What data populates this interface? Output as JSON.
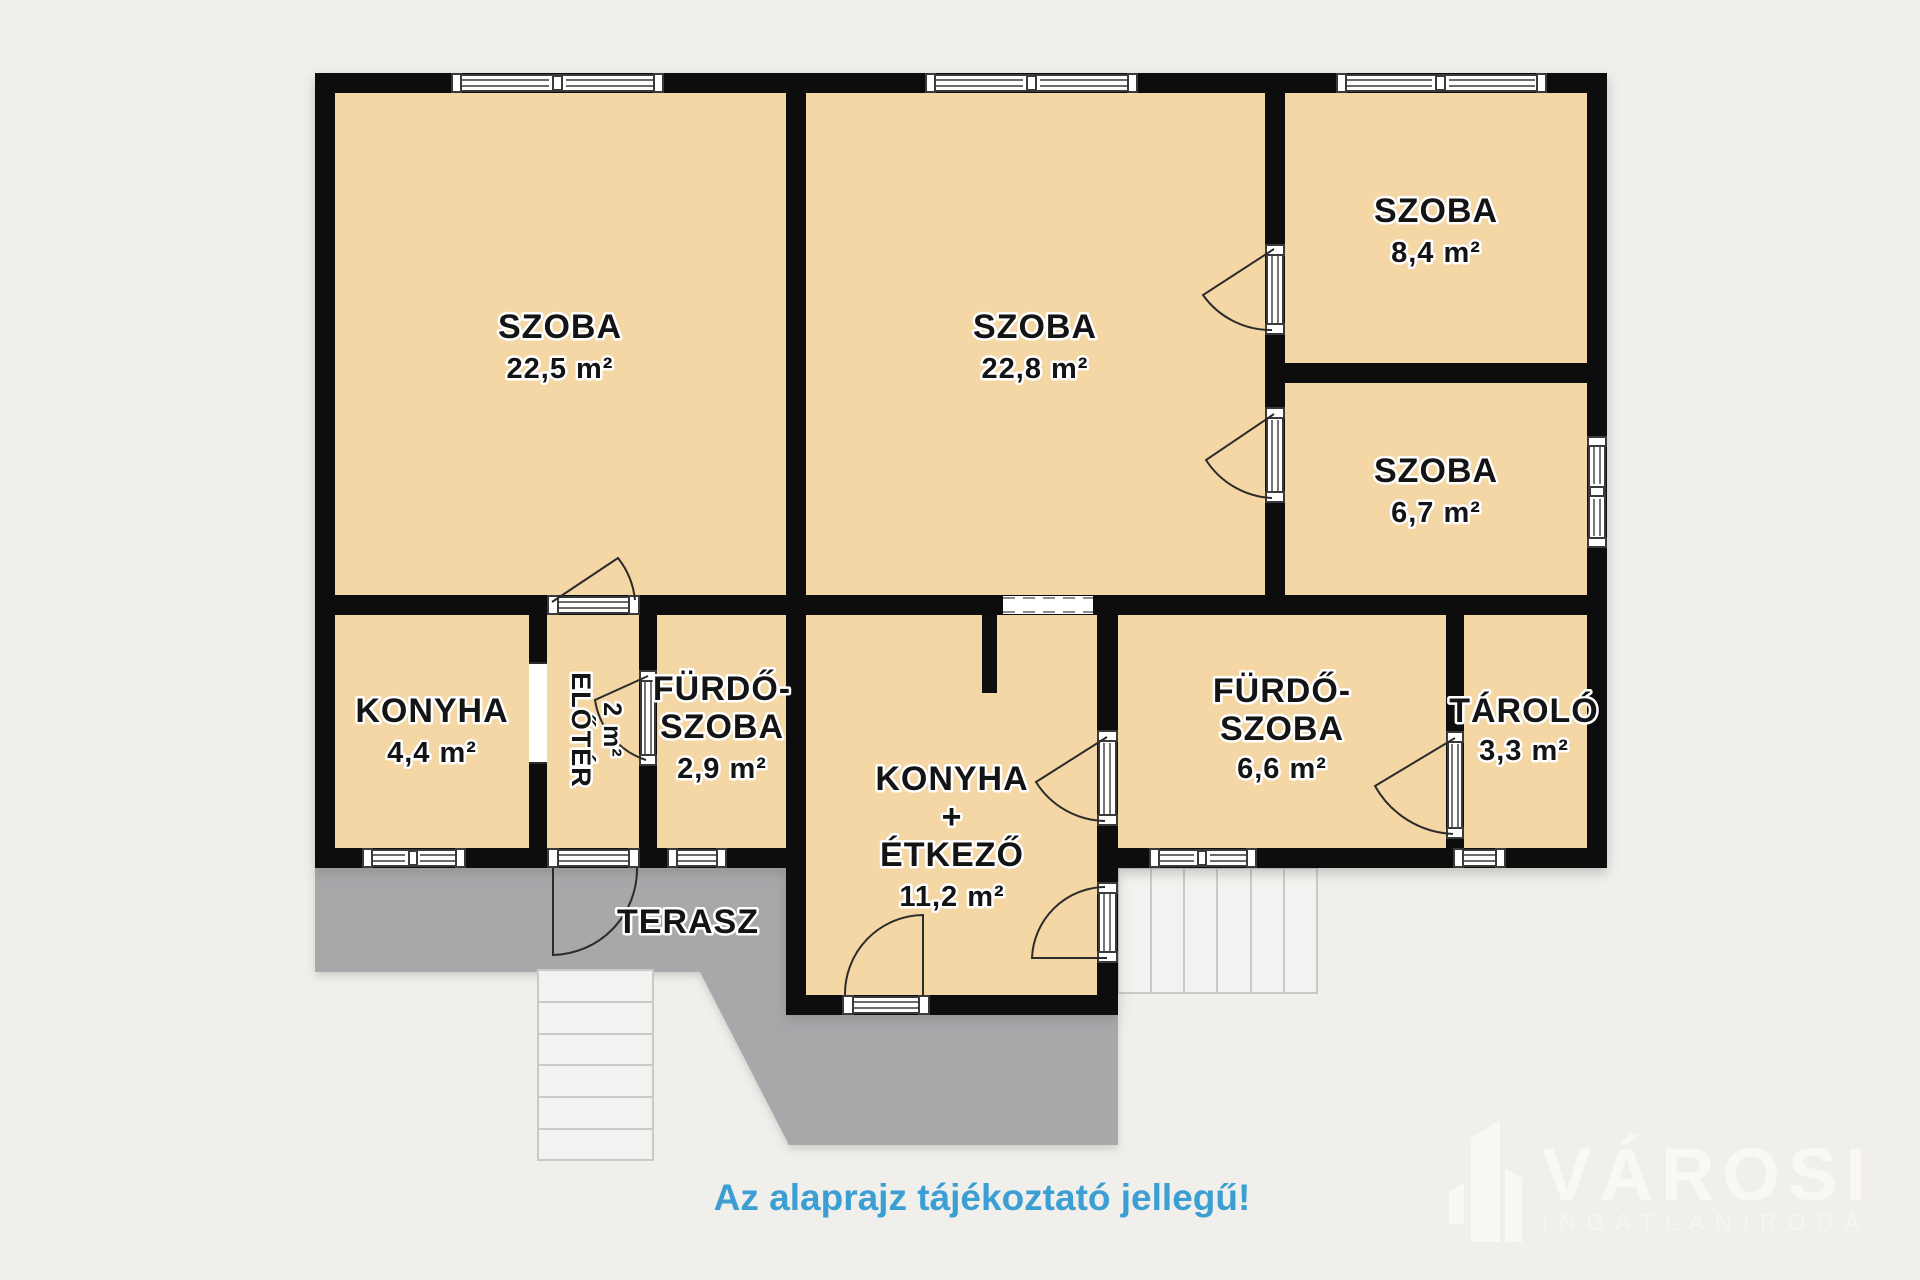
{
  "plan": {
    "rooms": {
      "szoba_22_5": {
        "name": "SZOBA",
        "area": "22,5 m²"
      },
      "szoba_22_8": {
        "name": "SZOBA",
        "area": "22,8 m²"
      },
      "szoba_8_4": {
        "name": "SZOBA",
        "area": "8,4 m²"
      },
      "szoba_6_7": {
        "name": "SZOBA",
        "area": "6,7 m²"
      },
      "konyha": {
        "name": "KONYHA",
        "area": "4,4 m²"
      },
      "eloter": {
        "name": "ELŐTÉR",
        "area": "2 m²"
      },
      "furdoszoba_2_9": {
        "name1": "FÜRDŐ-",
        "name2": "SZOBA",
        "area": "2,9 m²"
      },
      "konyha_etkezo": {
        "name1": "KONYHA",
        "plus": "+",
        "name2": "ÉTKEZŐ",
        "area": "11,2 m²"
      },
      "furdoszoba_6_6": {
        "name1": "FÜRDŐ-",
        "name2": "SZOBA",
        "area": "6,6 m²"
      },
      "tarolo": {
        "name": "TÁROLÓ",
        "area": "3,3 m²"
      },
      "terasz": {
        "name": "TERASZ"
      }
    },
    "caption": "Az alaprajz tájékoztató jellegű!",
    "logo": {
      "brand": "VÁROSI",
      "subtitle": "INGATLANIRODA"
    },
    "colors": {
      "background": "#f0efeb",
      "room_fill": "#f4d7a4",
      "wall": "#0f0f0f",
      "terrace": "#a8a8ab",
      "caption_blue": "#3b9fd4",
      "logo_watermark": "#faf8f3"
    }
  }
}
